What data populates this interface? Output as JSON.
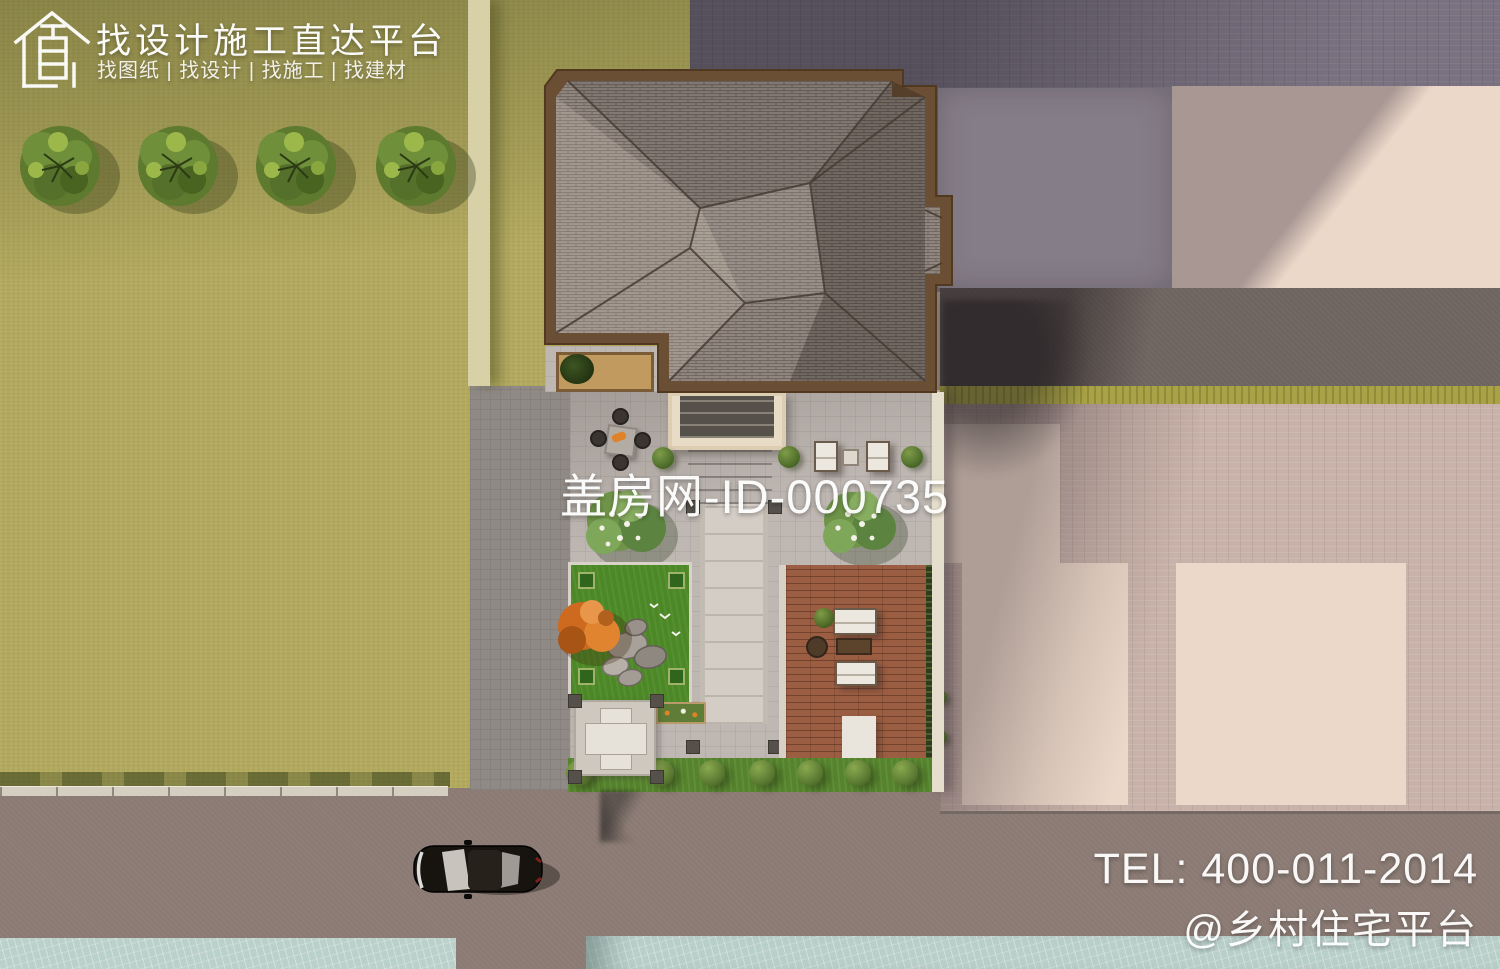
{
  "watermarks": {
    "brand": {
      "logo_icon": "house-logo-icon",
      "title": "找设计施工直达平台",
      "subtitle": "找图纸 | 找设计 | 找施工 | 找建材"
    },
    "center_id": "盖房网-ID-000735",
    "contact": {
      "tel": "TEL: 400-011-2014",
      "social": "@乡村住宅平台"
    }
  },
  "scene": {
    "type": "aerial-3d-architectural-render",
    "elements": [
      "grass-field",
      "street-trees",
      "hip-roof-house",
      "courtyard",
      "entry-porch",
      "stone-walkway",
      "dining-set",
      "sun-loungers",
      "flowering-trees",
      "rock-garden-lawn",
      "orange-tree",
      "wood-deck",
      "deck-furniture",
      "cross-paved-patio",
      "hedge-row",
      "driveway",
      "boundary-wall",
      "road",
      "parked-car",
      "river",
      "neighbor-plaza",
      "neighbor-pavement"
    ]
  },
  "colors": {
    "grass": "#b2a95e",
    "roof_shingle": "#918780",
    "roof_trim": "#6b4f35",
    "courtyard_paving": "#beb7b2",
    "deck_wood": "#9c5e42",
    "lawn_green": "#4c8826",
    "plaza_brick": "#c9b2a9",
    "pad_cream": "#ecd8c9",
    "road": "#8b7b74",
    "water": "#bad0cb",
    "watermark_text": "#ffffff"
  }
}
